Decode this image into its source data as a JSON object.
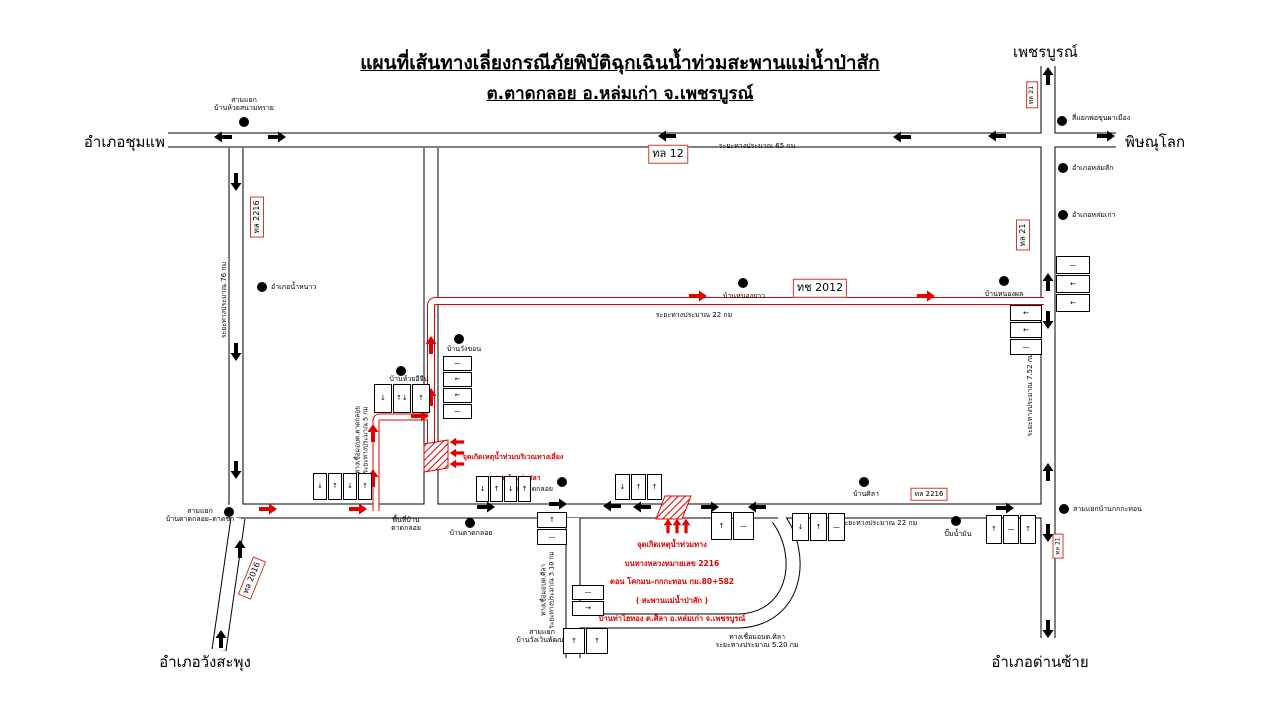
{
  "title": {
    "line1": "แผนที่เส้นทางเลี่ยงกรณีภัยพิบัติฉุกเฉินน้ำท่วมสะพานแม่น้ำป่าสัก",
    "line2": "ต.ตาดกลอย อ.หล่มเก่า จ.เพชรบูรณ์"
  },
  "destinations": {
    "top_right": "เพชรบูรณ์",
    "right": "พิษณุโลก",
    "left": "อำเภอชุมแพ",
    "bottom_left": "อำเภอวังสะพุง",
    "bottom_right": "อำเภอด่านซ้าย"
  },
  "flood_points": {
    "bypass": {
      "line1": "จุดเกิดเหตุน้ำท่วมบริเวณทางเลี่ยง",
      "line2": "สะพานห้วยท่าปลา"
    },
    "main": {
      "lines": [
        "จุดเกิดเหตุน้ำท่วมทาง",
        "บนทางหลวงหมายเลข 2216",
        "ตอน  โคกมน–กกกะทอน  กม.80+582",
        "( สะพานแม่น้ำป่าสัก )",
        "บ้านท่าไฮทอง ต.ศิลา อ.หล่มเก่า จ.เพชรบูรณ์"
      ]
    }
  },
  "colors": {
    "road_casing": "#000000",
    "road_fill": "#ffffff",
    "detour_route": "#e30000",
    "badge_border": "#cf3a2d",
    "flood_text": "#e30000"
  },
  "map": {
    "badges": [
      {
        "text": "ทล  12",
        "x": 668,
        "y": 154,
        "size": 11,
        "rotate": 0
      },
      {
        "text": "ทล  2216",
        "x": 257,
        "y": 217,
        "size": 8,
        "rotate": -90
      },
      {
        "text": "ทล  21",
        "x": 1032,
        "y": 95,
        "size": 6.5,
        "rotate": -90
      },
      {
        "text": "ทล  21",
        "x": 1023,
        "y": 235,
        "size": 8,
        "rotate": -90
      },
      {
        "text": "ทช  2012",
        "x": 820,
        "y": 288,
        "size": 11,
        "rotate": 0
      },
      {
        "text": "ทล  2216",
        "x": 929,
        "y": 494,
        "size": 7,
        "rotate": 0
      },
      {
        "text": "ทล  2016",
        "x": 252,
        "y": 578,
        "size": 8,
        "rotate": -68
      },
      {
        "text": "ทล  21",
        "x": 1058,
        "y": 546,
        "size": 6,
        "rotate": -90
      }
    ],
    "dots": [
      {
        "x": 244,
        "y": 122,
        "name": "junction-ban-huai-sanam-sai"
      },
      {
        "x": 1062,
        "y": 121,
        "name": "junction-pho-khun-pha-mueang"
      },
      {
        "x": 1063,
        "y": 168,
        "name": "amphoe-lom-sak"
      },
      {
        "x": 1063,
        "y": 215,
        "name": "amphoe-lom-kao"
      },
      {
        "x": 262,
        "y": 287,
        "name": "amphoe-nam-nao"
      },
      {
        "x": 743,
        "y": 283,
        "name": "ban-nong-yao"
      },
      {
        "x": 1004,
        "y": 281,
        "name": "ban-nong-phon"
      },
      {
        "x": 459,
        "y": 339,
        "name": "ban-wang-khon"
      },
      {
        "x": 401,
        "y": 371,
        "name": "ban-huai-i-chin"
      },
      {
        "x": 229,
        "y": 512,
        "name": "junction-tat-kloi-tat-kha"
      },
      {
        "x": 562,
        "y": 482,
        "name": "obt-tat-kloi"
      },
      {
        "x": 470,
        "y": 523,
        "name": "ban-tat-kloi"
      },
      {
        "x": 864,
        "y": 482,
        "name": "ban-sila"
      },
      {
        "x": 956,
        "y": 521,
        "name": "gas-station"
      },
      {
        "x": 1064,
        "y": 509,
        "name": "junction-ban-kok-kathon"
      }
    ],
    "labels": [
      {
        "text": "สามแยก\nบ้านห้วยสนามทราย",
        "x": 244,
        "y": 104,
        "size": 7,
        "anchor": "center"
      },
      {
        "text": "สี่แยกพ่อขุนผาเมือง",
        "x": 1072,
        "y": 118,
        "size": 7,
        "anchor": "left"
      },
      {
        "text": "อำเภอหล่มสัก",
        "x": 1072,
        "y": 168,
        "size": 7,
        "anchor": "left"
      },
      {
        "text": "อำเภอหล่มเก่า",
        "x": 1072,
        "y": 215,
        "size": 7,
        "anchor": "left"
      },
      {
        "text": "อำเภอน้ำหนาว",
        "x": 271,
        "y": 287,
        "size": 7,
        "anchor": "left"
      },
      {
        "text": "บ้านหนองยาว",
        "x": 744,
        "y": 296,
        "size": 7,
        "anchor": "center"
      },
      {
        "text": "บ้านหนองผล",
        "x": 1004,
        "y": 294,
        "size": 7,
        "anchor": "center"
      },
      {
        "text": "บ้านวังขอน",
        "x": 464,
        "y": 349,
        "size": 7,
        "anchor": "center"
      },
      {
        "text": "บ้านห้วยอีจีน",
        "x": 409,
        "y": 379,
        "size": 7,
        "anchor": "center"
      },
      {
        "text": "สามแยก\nบ้านตาดกลอย–ตาดข่า",
        "x": 200,
        "y": 515,
        "size": 7,
        "anchor": "center"
      },
      {
        "text": "พื้นที่บ้าน\nตาดกลอย",
        "x": 406,
        "y": 524,
        "size": 7,
        "anchor": "center"
      },
      {
        "text": "บ้านตาดกลอย",
        "x": 471,
        "y": 533,
        "size": 7,
        "anchor": "center"
      },
      {
        "text": "อบต. ตาดกลอย",
        "x": 553,
        "y": 489,
        "size": 7,
        "anchor": "right"
      },
      {
        "text": "บ้านศิลา",
        "x": 866,
        "y": 494,
        "size": 7,
        "anchor": "center"
      },
      {
        "text": "ปั๊มน้ำมัน",
        "x": 958,
        "y": 534,
        "size": 7,
        "anchor": "center"
      },
      {
        "text": "สามแยกบ้านกกกะทอน",
        "x": 1073,
        "y": 509,
        "size": 7,
        "anchor": "left"
      },
      {
        "text": "สามแยก\nบ้านวังเวินพัฒนา",
        "x": 542,
        "y": 636,
        "size": 7,
        "anchor": "center"
      },
      {
        "text": "ระยะทางประมาณ  65 กม",
        "x": 757,
        "y": 146,
        "size": 7,
        "anchor": "center"
      },
      {
        "text": "ระยะทางประมาณ  22 กม",
        "x": 694,
        "y": 315,
        "size": 7,
        "anchor": "center"
      },
      {
        "text": "ระยะทางประมาณ  22 กม",
        "x": 879,
        "y": 523,
        "size": 7,
        "anchor": "center"
      },
      {
        "text": "ระยะทางประมาณ  76 กม",
        "x": 224,
        "y": 300,
        "size": 7,
        "anchor": "center",
        "rotate": -90
      },
      {
        "text": "ระยะทางประมาณ  7.52 กม",
        "x": 1030,
        "y": 395,
        "size": 7,
        "anchor": "center",
        "rotate": -90
      },
      {
        "text": "ทางเชื่อมอบต.ตาดกลอย\nระยะทางประมาณ 5 กม",
        "x": 362,
        "y": 440,
        "size": 6.5,
        "anchor": "center",
        "rotate": -90
      },
      {
        "text": "ทางเชื่อมอบต.ศิลา\nระยะทางประมาณ 3.10 กม",
        "x": 548,
        "y": 590,
        "size": 6.5,
        "anchor": "center",
        "rotate": -90
      },
      {
        "text": "ทางเชื่อมอบต.ศิลา\nระยะทางประมาณ  5.20 กม",
        "x": 757,
        "y": 641,
        "size": 7,
        "anchor": "center"
      }
    ],
    "arrows": [
      {
        "x": 223,
        "y": 137,
        "dir": "left",
        "color": "black"
      },
      {
        "x": 277,
        "y": 137,
        "dir": "right",
        "color": "black"
      },
      {
        "x": 667,
        "y": 136,
        "dir": "left",
        "color": "black"
      },
      {
        "x": 902,
        "y": 137,
        "dir": "left",
        "color": "black"
      },
      {
        "x": 997,
        "y": 136,
        "dir": "left",
        "color": "black"
      },
      {
        "x": 1106,
        "y": 136,
        "dir": "right",
        "color": "black"
      },
      {
        "x": 236,
        "y": 182,
        "dir": "down",
        "color": "black"
      },
      {
        "x": 236,
        "y": 352,
        "dir": "down",
        "color": "black"
      },
      {
        "x": 236,
        "y": 470,
        "dir": "down",
        "color": "black"
      },
      {
        "x": 1048,
        "y": 76,
        "dir": "up",
        "color": "black"
      },
      {
        "x": 1048,
        "y": 282,
        "dir": "up",
        "color": "black"
      },
      {
        "x": 1048,
        "y": 320,
        "dir": "down",
        "color": "black"
      },
      {
        "x": 1048,
        "y": 472,
        "dir": "up",
        "color": "black"
      },
      {
        "x": 1048,
        "y": 533,
        "dir": "down",
        "color": "black"
      },
      {
        "x": 1048,
        "y": 629,
        "dir": "down",
        "color": "black"
      },
      {
        "x": 240,
        "y": 549,
        "dir": "up",
        "color": "black"
      },
      {
        "x": 221,
        "y": 639,
        "dir": "up",
        "color": "black"
      },
      {
        "x": 486,
        "y": 507,
        "dir": "right",
        "color": "black"
      },
      {
        "x": 558,
        "y": 504,
        "dir": "right",
        "color": "black"
      },
      {
        "x": 612,
        "y": 506,
        "dir": "left",
        "color": "black"
      },
      {
        "x": 642,
        "y": 507,
        "dir": "left",
        "color": "black"
      },
      {
        "x": 710,
        "y": 507,
        "dir": "right",
        "color": "black"
      },
      {
        "x": 757,
        "y": 507,
        "dir": "left",
        "color": "black"
      },
      {
        "x": 1005,
        "y": 508,
        "dir": "right",
        "color": "black"
      },
      {
        "x": 268,
        "y": 509,
        "dir": "right",
        "color": "red"
      },
      {
        "x": 358,
        "y": 509,
        "dir": "right",
        "color": "red"
      },
      {
        "x": 373,
        "y": 478,
        "dir": "up",
        "color": "red"
      },
      {
        "x": 373,
        "y": 433,
        "dir": "up",
        "color": "red"
      },
      {
        "x": 420,
        "y": 416,
        "dir": "right",
        "color": "red"
      },
      {
        "x": 431,
        "y": 397,
        "dir": "up",
        "color": "red"
      },
      {
        "x": 431,
        "y": 345,
        "dir": "up",
        "color": "red"
      },
      {
        "x": 698,
        "y": 296,
        "dir": "right",
        "color": "red"
      },
      {
        "x": 926,
        "y": 296,
        "dir": "right",
        "color": "red"
      },
      {
        "x": 457,
        "y": 442,
        "dir": "left",
        "color": "red",
        "scale": 0.8
      },
      {
        "x": 457,
        "y": 453,
        "dir": "left",
        "color": "red",
        "scale": 0.8
      },
      {
        "x": 457,
        "y": 464,
        "dir": "left",
        "color": "red",
        "scale": 0.8
      },
      {
        "x": 668,
        "y": 526,
        "dir": "up",
        "color": "red",
        "scale": 0.8
      },
      {
        "x": 677,
        "y": 526,
        "dir": "up",
        "color": "red",
        "scale": 0.8
      },
      {
        "x": 686,
        "y": 526,
        "dir": "up",
        "color": "red",
        "scale": 0.8
      }
    ],
    "signs": [
      {
        "x": 374,
        "y": 384,
        "layout": "row",
        "pw": 16,
        "ph": 27,
        "plates": [
          "↓",
          "↑↓",
          "↑"
        ]
      },
      {
        "x": 443,
        "y": 356,
        "layout": "col",
        "pw": 27,
        "ph": 13,
        "plates": [
          "—",
          "←",
          "←",
          "—"
        ]
      },
      {
        "x": 313,
        "y": 473,
        "layout": "row",
        "pw": 12,
        "ph": 25,
        "plates": [
          "↓",
          "↑",
          "↓",
          "↑"
        ]
      },
      {
        "x": 476,
        "y": 476,
        "layout": "row",
        "pw": 11,
        "ph": 24,
        "plates": [
          "↓",
          "↑",
          "↓",
          "↑"
        ]
      },
      {
        "x": 615,
        "y": 474,
        "layout": "row",
        "pw": 13,
        "ph": 24,
        "plates": [
          "↓",
          "↑",
          "↑"
        ]
      },
      {
        "x": 537,
        "y": 512,
        "layout": "col",
        "pw": 28,
        "ph": 14,
        "plates": [
          "↑",
          "—"
        ]
      },
      {
        "x": 711,
        "y": 512,
        "layout": "row",
        "pw": 19,
        "ph": 26,
        "plates": [
          "↑",
          "—"
        ]
      },
      {
        "x": 792,
        "y": 513,
        "layout": "row",
        "pw": 15,
        "ph": 26,
        "plates": [
          "↓",
          "↑",
          "—"
        ]
      },
      {
        "x": 986,
        "y": 515,
        "layout": "row",
        "pw": 14,
        "ph": 27,
        "plates": [
          "↑",
          "—",
          "↑"
        ]
      },
      {
        "x": 572,
        "y": 585,
        "layout": "col",
        "pw": 30,
        "ph": 13,
        "plates": [
          "—",
          "→"
        ]
      },
      {
        "x": 563,
        "y": 628,
        "layout": "row",
        "pw": 20,
        "ph": 24,
        "plates": [
          "↑",
          "↑"
        ]
      },
      {
        "x": 1056,
        "y": 256,
        "layout": "col",
        "pw": 32,
        "ph": 16,
        "plates": [
          "—",
          "←",
          "←"
        ]
      },
      {
        "x": 1010,
        "y": 305,
        "layout": "col",
        "pw": 30,
        "ph": 14,
        "plates": [
          "←",
          "←",
          "—"
        ]
      }
    ]
  }
}
